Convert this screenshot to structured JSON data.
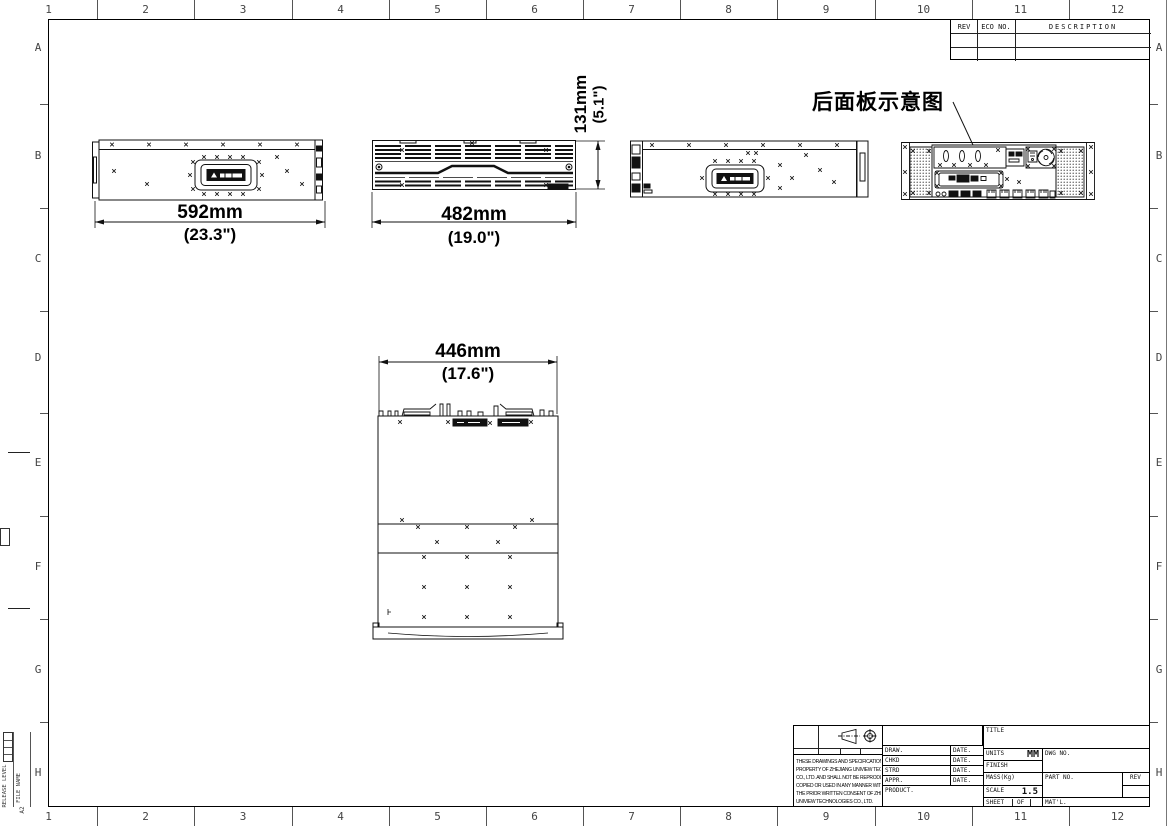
{
  "sheet": {
    "paper_size": "A2",
    "release_level_label": "RELEASE LEVEL",
    "file_name_label": "FILE NAME",
    "grid_columns": [
      "1",
      "2",
      "3",
      "4",
      "5",
      "6",
      "7",
      "8",
      "9",
      "10",
      "11",
      "12"
    ],
    "grid_rows": [
      "A",
      "B",
      "C",
      "D",
      "E",
      "F",
      "G",
      "H"
    ]
  },
  "revision_table": {
    "rev_header": "REV",
    "eco_header": "ECO NO.",
    "description_header": "DESCRIPTION"
  },
  "annotations": {
    "rear_panel_label": "后面板示意图"
  },
  "dimensions": {
    "side_width_mm": "592mm",
    "side_width_in": "(23.3\")",
    "front_width_mm": "482mm",
    "front_width_in": "(19.0\")",
    "height_mm": "131mm",
    "height_in": "(5.1\")",
    "top_width_mm": "446mm",
    "top_width_in": "(17.6\")"
  },
  "title_block": {
    "title_label": "TITLE",
    "draw_label": "DRAW.",
    "chkd_label": "CHKD",
    "strd_label": "STRD",
    "appr_label": "APPR.",
    "date_label": "DATE.",
    "product_label": "PRODUCT.",
    "units_label": "UNITS",
    "units_value": "MM",
    "finish_label": "FINISH",
    "mass_label": "MASS(Kg)",
    "scale_label": "SCALE",
    "scale_value": "1.5",
    "sheet_label": "SHEET",
    "of_label": "OF",
    "dwg_label": "DWG NO.",
    "part_label": "PART NO.",
    "rev_label": "REV",
    "matl_label": "MAT'L.",
    "notice_lines": [
      "THESE DRAWINGS AND SPECIFICATION ARE THE",
      "PROPERTY OF ZHEJIANG UNIVIEW TECHNOLOGIES",
      "CO., LTD. AND SHALL NOT BE REPRODUCED",
      "COPIED OR USED IN ANY MANNER WITHOUT",
      "THE PRIOR WRITTEN CONSENT OF ZHEJIANG",
      "UNIVIEW TECHNOLOGIES CO., LTD."
    ]
  }
}
